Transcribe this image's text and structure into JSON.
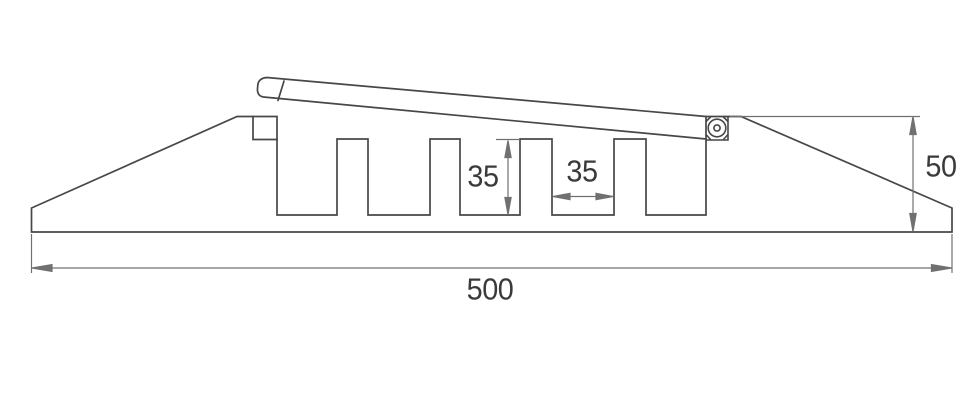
{
  "drawing": {
    "dimension_labels": {
      "overall_width": "500",
      "overall_height": "50",
      "slot_depth": "35",
      "slot_width": "35"
    },
    "colors": {
      "background": "#ffffff",
      "outline": "#474747",
      "dimension": "#707070",
      "text": "#3a3a3a"
    }
  }
}
